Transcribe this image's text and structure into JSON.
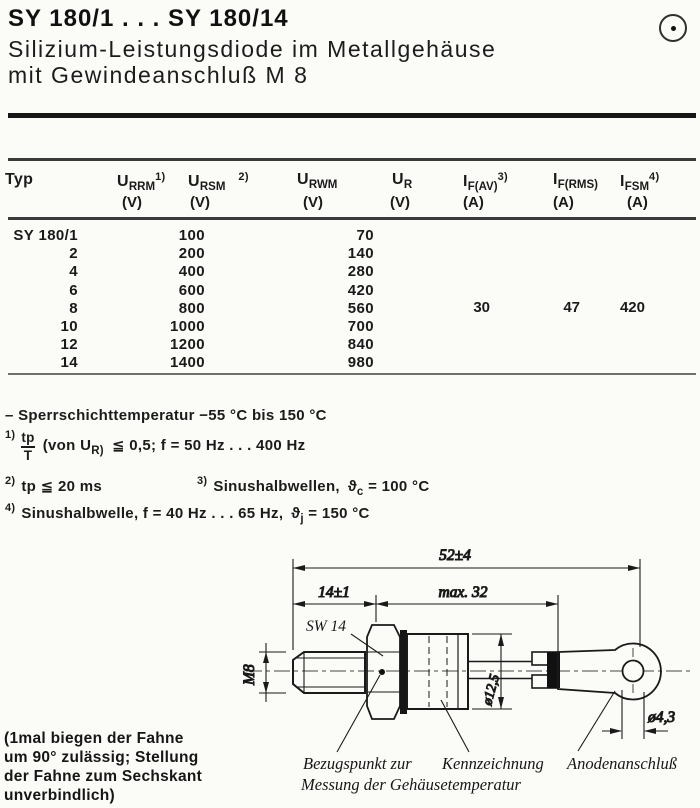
{
  "header": {
    "title": "SY 180/1 . . . SY 180/14",
    "subtitle_line1": "Silizium-Leistungsdiode im Metallgehäuse",
    "subtitle_line2": "mit Gewindeanschluß M 8",
    "corner_icon": "circled-dot"
  },
  "colors": {
    "ink": "#1a1a1a",
    "paper": "#fbfbf8"
  },
  "table": {
    "columns": [
      {
        "base": "Typ",
        "sub": "",
        "sup": "",
        "unit": ""
      },
      {
        "base": "U",
        "sub": "RRM",
        "sup": "1)",
        "unit": "(V)"
      },
      {
        "base": "U",
        "sub": "RSM",
        "sup": "2)",
        "unit": "(V)"
      },
      {
        "base": "U",
        "sub": "RWM",
        "sup": "",
        "unit": "(V)"
      },
      {
        "base": "U",
        "sub": "R",
        "sup": "",
        "unit": "(V)"
      },
      {
        "base": "I",
        "sub": "F(AV)",
        "sup": "3)",
        "unit": "(A)"
      },
      {
        "base": "I",
        "sub": "F(RMS)",
        "sup": "",
        "unit": "(A)"
      },
      {
        "base": "I",
        "sub": "FSM",
        "sup": "4)",
        "unit": "(A)"
      }
    ],
    "rows": [
      {
        "typ": "SY 180/1",
        "urrm": "100",
        "urwm": "70"
      },
      {
        "typ": "2",
        "urrm": "200",
        "urwm": "140"
      },
      {
        "typ": "4",
        "urrm": "400",
        "urwm": "280"
      },
      {
        "typ": "6",
        "urrm": "600",
        "urwm": "420"
      },
      {
        "typ": "8",
        "urrm": "800",
        "urwm": "560"
      },
      {
        "typ": "10",
        "urrm": "1000",
        "urwm": "700"
      },
      {
        "typ": "12",
        "urrm": "1200",
        "urwm": "840"
      },
      {
        "typ": "14",
        "urrm": "1400",
        "urwm": "980"
      }
    ],
    "shared_values": {
      "if_av": "30",
      "if_rms": "47",
      "ifsm": "420"
    }
  },
  "notes": {
    "temp": "– Sperrschichttemperatur −55 °C bis 150 °C",
    "n1": {
      "marker": "1)",
      "num": "tp",
      "den": "T",
      "mid": "(von U",
      "sub": "R)",
      "rest": "≦ 0,5; f = 50 Hz . . . 400 Hz"
    },
    "n2": {
      "marker": "2)",
      "text": "tp ≦ 20 ms"
    },
    "n3": {
      "marker": "3)",
      "text": "Sinushalbwellen,",
      "theta": "ϑ",
      "theta_sub": "c",
      "value": "= 100 °C"
    },
    "n4": {
      "marker": "4)",
      "text": "Sinushalbwelle, f = 40 Hz . . . 65 Hz,",
      "theta": "ϑ",
      "theta_sub": "j",
      "value": "= 150 °C"
    }
  },
  "drawing": {
    "dim_overall": "52±4",
    "dim_stud": "14±1",
    "dim_body": "max. 32",
    "dim_hex": "SW 14",
    "dim_thread": "M8",
    "dim_diameter": "ø12,5",
    "dim_hole": "ø4,3",
    "label_ref_line1": "Bezugspunkt zur",
    "label_ref_line2": "Messung der Gehäusetemperatur",
    "label_marking": "Kennzeichnung",
    "label_anode": "Anodenanschluß",
    "note_lines": [
      "(1mal biegen der Fahne",
      "um 90° zulässig; Stellung",
      "der Fahne zum Sechskant",
      "unverbindlich)"
    ]
  }
}
